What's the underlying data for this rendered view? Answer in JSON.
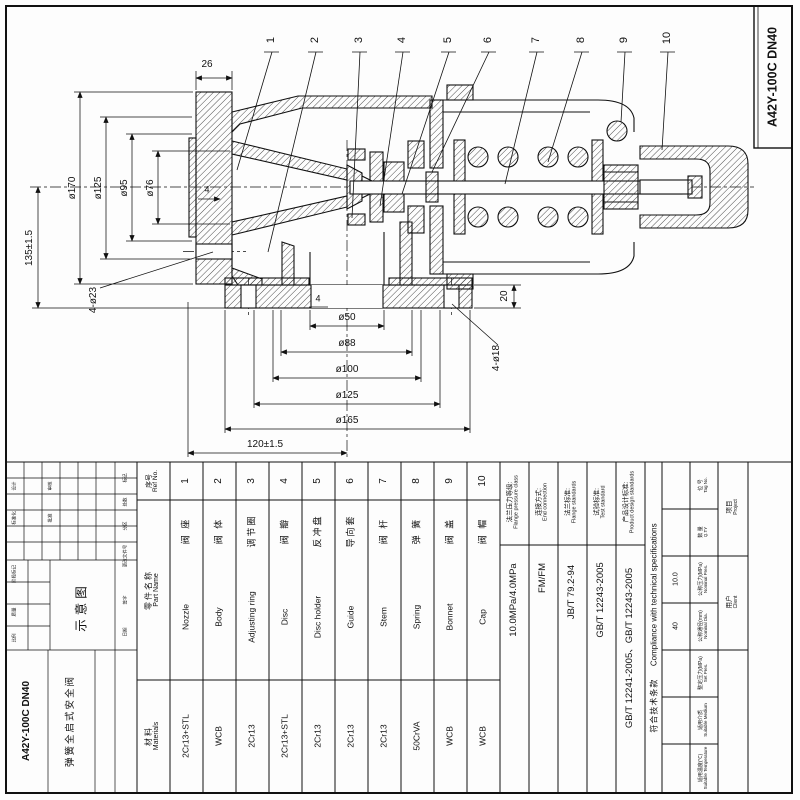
{
  "page": {
    "model": "A42Y-100C DN40",
    "product_name": "弹簧全启式安全阀",
    "schematic_label": "示意图"
  },
  "callouts": {
    "c1": "1",
    "c2": "2",
    "c3": "3",
    "c4": "4",
    "c5": "5",
    "c6": "6",
    "c7": "7",
    "c8": "8",
    "c9": "9",
    "c10": "10"
  },
  "dims": {
    "d26": "26",
    "d170": "ø170",
    "d125i": "ø125",
    "d95": "ø95",
    "d76": "ø76",
    "d135": "135±1.5",
    "d423": "4-ø23",
    "d50": "ø50",
    "d88": "ø88",
    "d100": "ø100",
    "d125o": "ø125",
    "d165": "ø165",
    "d120": "120±1.5",
    "d20": "20",
    "d418": "4-ø18",
    "t4a": "4",
    "t4b": "4"
  },
  "parts_table": {
    "header": {
      "no_cn": "序号",
      "no_en": "Ref No.",
      "name_cn": "零件名称",
      "name_en": "Part Name",
      "mat_cn": "材料",
      "mat_en": "Materials"
    },
    "parts": [
      {
        "no": "1",
        "cn": "阀 座",
        "en": "Nozzle",
        "mat": "2Cr13+STL"
      },
      {
        "no": "2",
        "cn": "阀 体",
        "en": "Body",
        "mat": "WCB"
      },
      {
        "no": "3",
        "cn": "调节圈",
        "en": "Adjusting ring",
        "mat": "2Cr13"
      },
      {
        "no": "4",
        "cn": "阀 瓣",
        "en": "Disc",
        "mat": "2Cr13+STL"
      },
      {
        "no": "5",
        "cn": "反冲盘",
        "en": "Disc holder",
        "mat": "2Cr13"
      },
      {
        "no": "6",
        "cn": "导向套",
        "en": "Guide",
        "mat": "2Cr13"
      },
      {
        "no": "7",
        "cn": "阀 杆",
        "en": "Stem",
        "mat": "2Cr13"
      },
      {
        "no": "8",
        "cn": "弹 簧",
        "en": "Spring",
        "mat": "50CrVA"
      },
      {
        "no": "9",
        "cn": "阀 盖",
        "en": "Bonnet",
        "mat": "WCB"
      },
      {
        "no": "10",
        "cn": "阀 帽",
        "en": "Cap",
        "mat": "WCB"
      }
    ]
  },
  "spec_table": {
    "compliance_cn": "符合技术条款",
    "compliance_en": "Compliance with technical specifications",
    "cols": [
      {
        "cn": "法兰压力等级:",
        "en": "Flange pressure class",
        "value": "10.0MPa/4.0MPa"
      },
      {
        "cn": "连接方式:",
        "en": "End connection",
        "value": "FM/FM"
      },
      {
        "cn": "法兰标准:",
        "en": "Flange standards",
        "value": "JB/T 79.2-94"
      },
      {
        "cn": "试验标准:",
        "en": "Test standard",
        "value": "GB/T 12243-2005"
      },
      {
        "cn": "产品设计标准:",
        "en": "Product design standards",
        "value": "GB/T 12241-2005、GB/T 12243-2005"
      }
    ]
  },
  "project_table": {
    "project_cn": "项目",
    "project_en": "Project",
    "client_cn": "用户",
    "client_en": "Client",
    "rows": [
      {
        "cn": "位 号",
        "en": "Tag No.",
        "value": ""
      },
      {
        "cn": "数 量",
        "en": "Q.TY",
        "value": ""
      },
      {
        "cn": "公称压力(MPa)",
        "en": "Nominal Pres.",
        "value": "10.0"
      },
      {
        "cn": "公称通径(mm)",
        "en": "Nominal Dia.",
        "value": "40"
      },
      {
        "cn": "整定压力(MPa)",
        "en": "Set Pres.",
        "value": ""
      },
      {
        "cn": "适用介质",
        "en": "Suitable Medium",
        "value": ""
      },
      {
        "cn": "适用温度(℃)",
        "en": "Suitable Temperature",
        "value": ""
      }
    ]
  },
  "titleblock": {
    "cells": [
      "标记",
      "处数",
      "分区",
      "更改文件号",
      "签字",
      "日期",
      "设计",
      "标准化",
      "审核",
      "批准",
      "阶段标记",
      "质量",
      "比例"
    ]
  }
}
